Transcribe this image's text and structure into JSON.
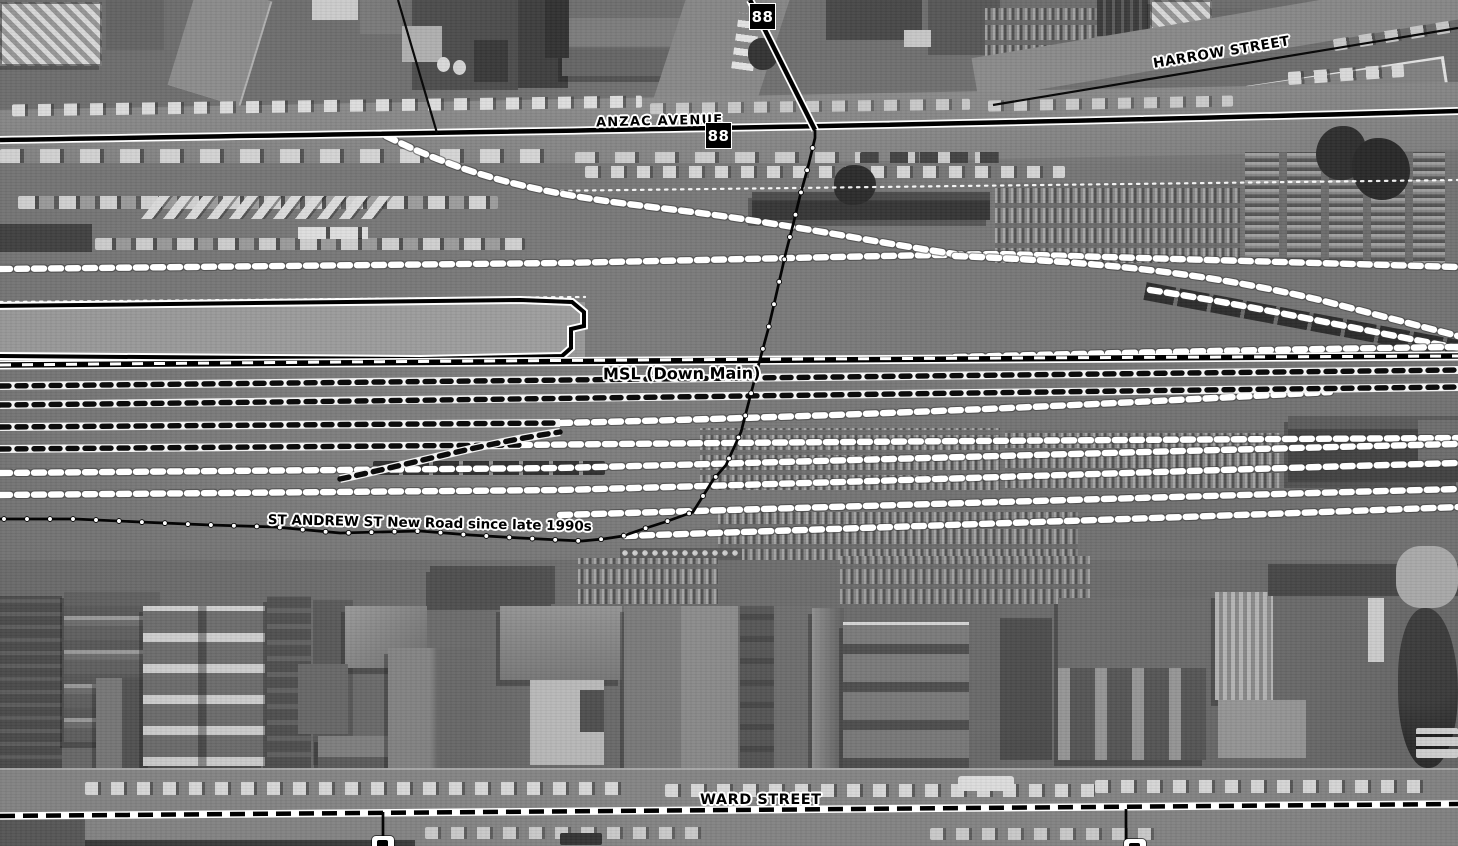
{
  "map": {
    "description": "Greyscale historical aerial photograph of a railway yard with rail-map line overlays",
    "labels": {
      "anzac_avenue": "ANZAC AVENUE",
      "harrow_street": "HARROW STREET",
      "ward_street": "WARD STREET",
      "msl_down_main": "MSL (Down Main)",
      "st_andrew": "ST ANDREW ST New Road since late 1990s"
    },
    "route_shields": [
      {
        "label": "88"
      },
      {
        "label": "88"
      }
    ],
    "colors": {
      "overlay_line": "#000000",
      "overlay_casing": "#ffffff",
      "label_text": "#000000",
      "label_halo": "#ffffff",
      "route_shield_bg": "#000000",
      "route_shield_text": "#ffffff"
    }
  }
}
